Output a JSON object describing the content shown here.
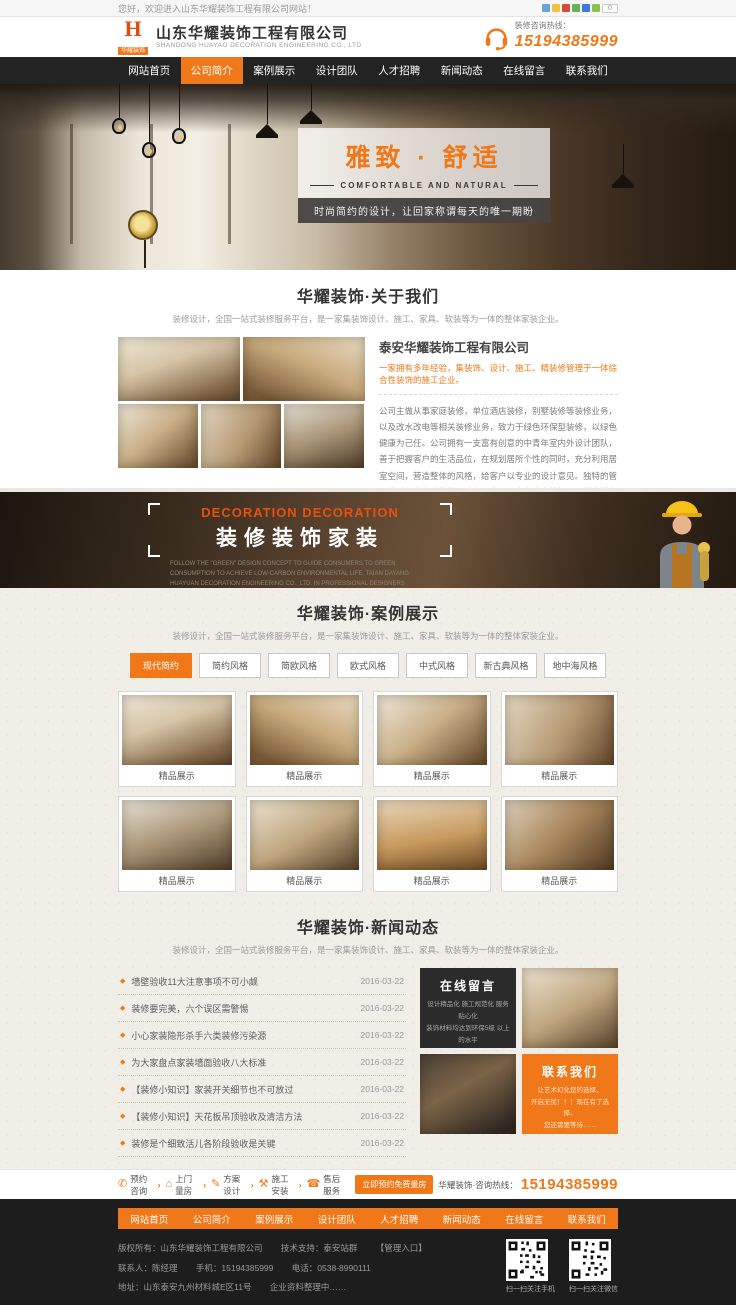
{
  "colors": {
    "accent": "#f07818",
    "nav_bg": "#232323",
    "footer_bg": "#1d1d1d"
  },
  "topbar": {
    "welcome": "您好，欢迎进入山东华耀装饰工程有限公司网站！",
    "share_count": "0",
    "share_icons": [
      {
        "name": "share-qq-icon",
        "color": "#66a6d2"
      },
      {
        "name": "share-qzone-icon",
        "color": "#f2c43b"
      },
      {
        "name": "share-weibo-icon",
        "color": "#d54a34"
      },
      {
        "name": "share-wechat-icon",
        "color": "#66b35a"
      },
      {
        "name": "share-baidu-icon",
        "color": "#3a7bd5"
      },
      {
        "name": "share-more-icon",
        "color": "#8cc152"
      }
    ]
  },
  "header": {
    "logo_mark": "H",
    "logo_name": "华耀装饰",
    "company_cn": "山东华耀装饰工程有限公司",
    "company_en": "SHANDONG HUAYAO DECORATION ENGINEERING CO., LTD",
    "hotline_label": "装修咨询热线：",
    "hotline_number": "15194385999"
  },
  "nav": {
    "items": [
      {
        "label": "网站首页",
        "active": false
      },
      {
        "label": "公司简介",
        "active": true
      },
      {
        "label": "案例展示",
        "active": false
      },
      {
        "label": "设计团队",
        "active": false
      },
      {
        "label": "人才招聘",
        "active": false
      },
      {
        "label": "新闻动态",
        "active": false
      },
      {
        "label": "在线留言",
        "active": false
      },
      {
        "label": "联系我们",
        "active": false
      }
    ]
  },
  "hero": {
    "title": "雅致 · 舒适",
    "subtitle_en": "COMFORTABLE AND NATURAL",
    "tagline": "时尚简约的设计，让回家称谓每天的唯一期盼"
  },
  "about": {
    "section_title": "华耀装饰·关于我们",
    "section_subtitle": "装修设计，全国一站式装修服务平台，是一家集装饰设计、施工、家具、软装等为一体的整体家装企业。",
    "company_title": "泰安华耀装饰工程有限公司",
    "highlight": "一家拥有多年经验，集装饰、设计、施工、精装修管理于一体综合性装饰的施工企业。",
    "paragraph": "公司主做从事家庭装修，单位酒店装修，别墅装修等装修业务，以及改水改电等相关装修业务，致力于绿色环保型装修，以绿色健康为己任。公司拥有一支富有创意的中青年室内外设计团队，善于把握客户的生活品位，在规划居所个性的同时，充分利用居室空间，营造整体的风格，给客户以专业的设计意见。独特的管理体系和高素质的施工队伍，赢得了广大客户的好评，越来越多的客户帮助了我们，了解了我们并选择我们。",
    "more_button": "查看更多",
    "contact_button": "联系我们"
  },
  "banner2": {
    "title_en": "DECORATION DECORATION",
    "title_cn": "装修装饰家装",
    "desc": "FOLLOW THE \"GREEN\" DESIGN CONCEPT TO GUIDE CONSUMERS TO GREEN CONSUMPTION TO ACHIEVE LOW-CARBON ENVIRONMENTAL LIFE. TAIAN DAYANG HUAYUAN DECORATION ENGINEERING CO., LTD. IN PROFESSIONAL DESIGNERS THROUGHOUT THE PRIVATE CUSTOM SO YOU SAVE TIME, WORRY, MORE EFFORT."
  },
  "cases": {
    "section_title": "华耀装饰·案例展示",
    "section_subtitle": "装修设计，全国一站式装修服务平台，是一家集装饰设计、施工、家具、软装等为一体的整体家装企业。",
    "tabs": [
      {
        "label": "现代简约",
        "active": true
      },
      {
        "label": "简约风格",
        "active": false
      },
      {
        "label": "简欧风格",
        "active": false
      },
      {
        "label": "欧式风格",
        "active": false
      },
      {
        "label": "中式风格",
        "active": false
      },
      {
        "label": "新古典风格",
        "active": false
      },
      {
        "label": "地中海风格",
        "active": false
      }
    ],
    "items": [
      {
        "caption": "精品展示"
      },
      {
        "caption": "精品展示"
      },
      {
        "caption": "精品展示"
      },
      {
        "caption": "精品展示"
      },
      {
        "caption": "精品展示"
      },
      {
        "caption": "精品展示"
      },
      {
        "caption": "精品展示"
      },
      {
        "caption": "精品展示"
      }
    ]
  },
  "news": {
    "section_title": "华耀装饰·新闻动态",
    "section_subtitle": "装修设计，全国一站式装修服务平台，是一家集装饰设计、施工、家具、软装等为一体的整体家装企业。",
    "items": [
      {
        "title": "墙壁验收11大注意事项不可小觑",
        "date": "2016-03-22"
      },
      {
        "title": "装修要完美，六个误区需警惕",
        "date": "2016-03-22"
      },
      {
        "title": "小心家装隐形杀手六类装修污染源",
        "date": "2016-03-22"
      },
      {
        "title": "为大家盘点家装墙面验收八大标准",
        "date": "2016-03-22"
      },
      {
        "title": "【装修小知识】家装开关细节也不可放过",
        "date": "2016-03-22"
      },
      {
        "title": "【装修小知识】天花板吊顶验收及清洁方法",
        "date": "2016-03-22"
      },
      {
        "title": "装修是个细致活儿各阶段验收是关键",
        "date": "2016-03-22"
      }
    ],
    "message_board": {
      "title": "在线留言",
      "line1": "设计精品化 施工规范化 服务贴心化",
      "line2": "装饰材料均达到环保5级 以上的水平"
    },
    "contact_box": {
      "title": "联系我们",
      "line1": "让艺术幻化您的选择，",
      "line2": "开启无忧！！！现在有了选择，",
      "line3": "您还需要等待……"
    }
  },
  "service_bar": {
    "steps": [
      {
        "icon": "phone-icon",
        "glyph": "✆",
        "label": "预约咨询"
      },
      {
        "icon": "house-icon",
        "glyph": "⌂",
        "label": "上门量房"
      },
      {
        "icon": "pencil-icon",
        "glyph": "✎",
        "label": "方案设计"
      },
      {
        "icon": "hammer-icon",
        "glyph": "⚒",
        "label": "施工安装"
      },
      {
        "icon": "headset-icon",
        "glyph": "☎",
        "label": "售后服务"
      }
    ],
    "chevron": "›",
    "book_button": "立即预约免费量房",
    "hotline_prefix": "华耀装饰·咨询热线：",
    "hotline_number": "15194385999"
  },
  "footer": {
    "copyright": "版权所有：山东华耀装饰工程有限公司",
    "support": "技术支持：泰安站群",
    "admin_entry": "【管理入口】",
    "contact_person": "联系人：陈经理",
    "mobile": "手机：15194385999",
    "telephone": "电话：0538-8990111",
    "address": "地址：山东泰安九州材料城E区11号",
    "note": "企业资料整理中……",
    "qr_mobile_caption": "扫一扫关注手机",
    "qr_wechat_caption": "扫一扫关注微信"
  }
}
